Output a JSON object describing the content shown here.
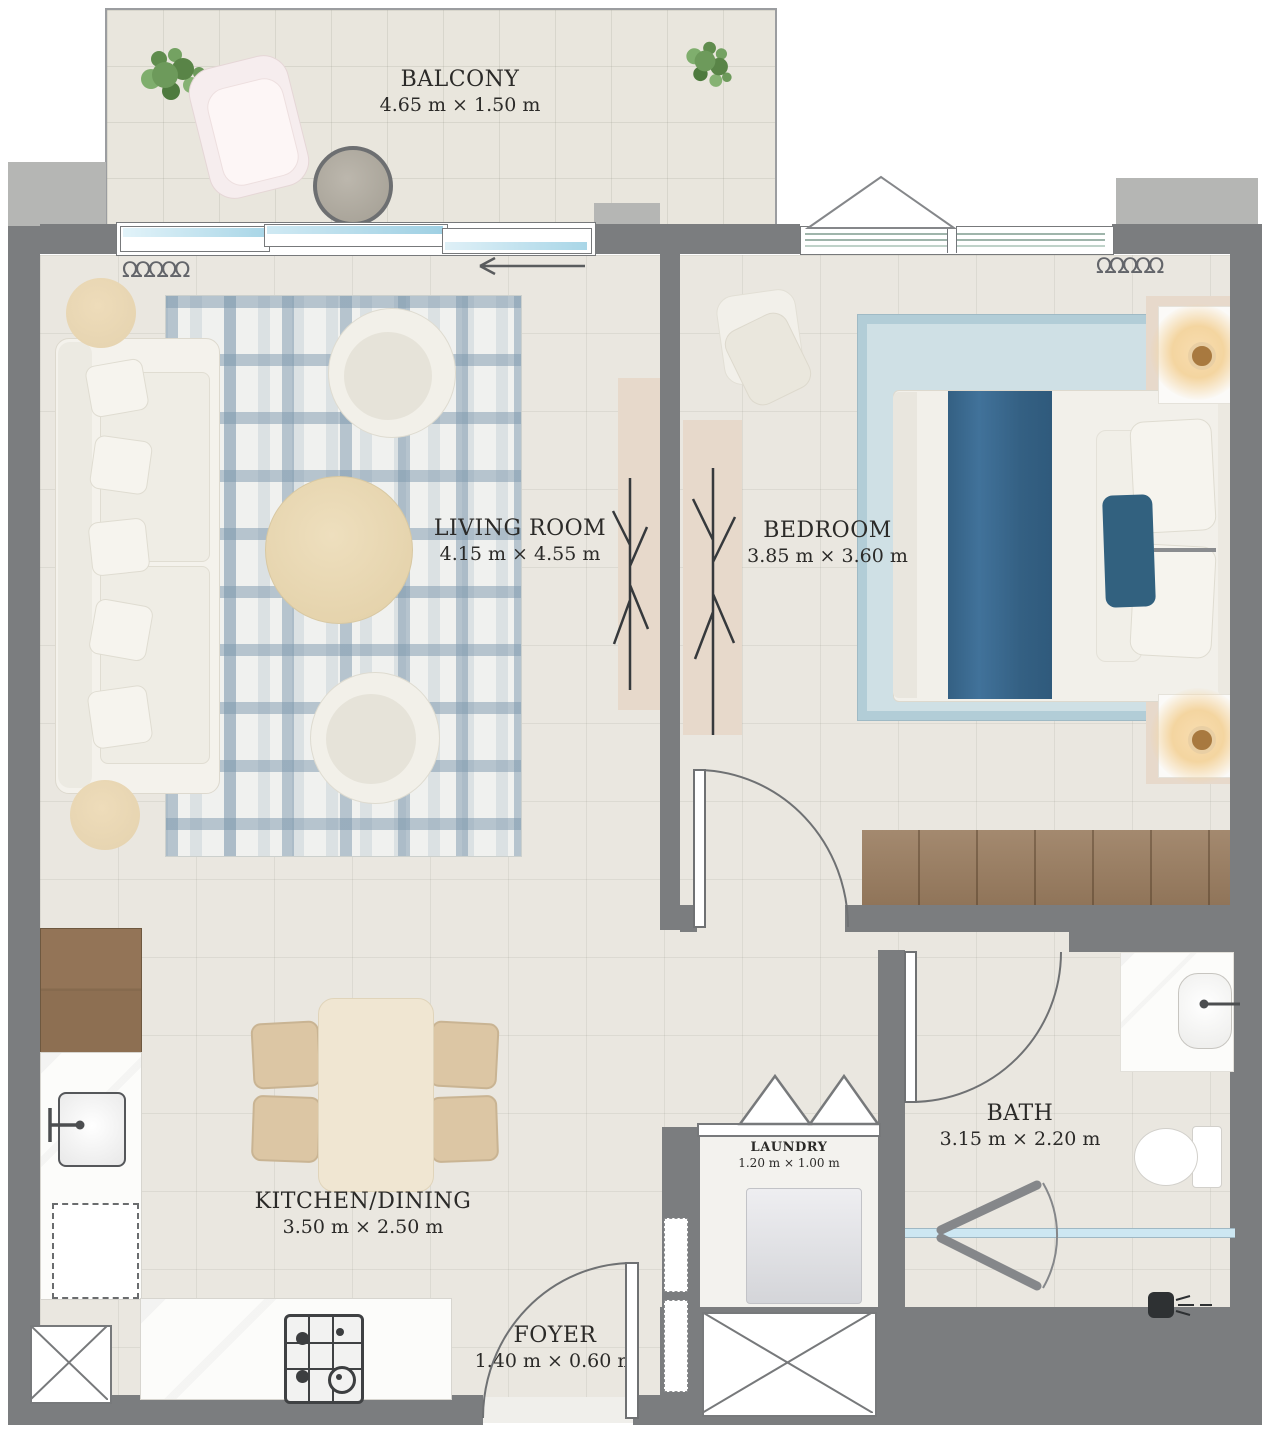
{
  "title": "Apartment floor plan",
  "colors": {
    "wall": "#7b7d7f",
    "wall_light": "#b5b6b4",
    "floor": "#eae7e0",
    "balcony_floor": "#e9e6dd",
    "glass": "#cde7f2",
    "wood": "#97795b",
    "rug_plaid_stripe": "#7d98ad",
    "bedroom_rug": "#cfe0e5",
    "bed_runner": "#3b6b8d",
    "label_text": "#2b2a28"
  },
  "icons": {
    "curtain_symbol": "ΩΩΩΩΩ"
  },
  "rooms": {
    "balcony": {
      "name": "BALCONY",
      "dims": "4.65 m × 1.50 m"
    },
    "living": {
      "name": "LIVING ROOM",
      "dims": "4.15 m × 4.55 m"
    },
    "bedroom": {
      "name": "BEDROOM",
      "dims": "3.85 m × 3.60 m"
    },
    "kitchen": {
      "name": "KITCHEN/DINING",
      "dims": "3.50 m × 2.50 m"
    },
    "bath": {
      "name": "BATH",
      "dims": "3.15 m × 2.20 m"
    },
    "laundry": {
      "name": "LAUNDRY",
      "dims": "1.20 m × 1.00 m"
    },
    "foyer": {
      "name": "FOYER",
      "dims": "1.40 m × 0.60 m"
    }
  }
}
